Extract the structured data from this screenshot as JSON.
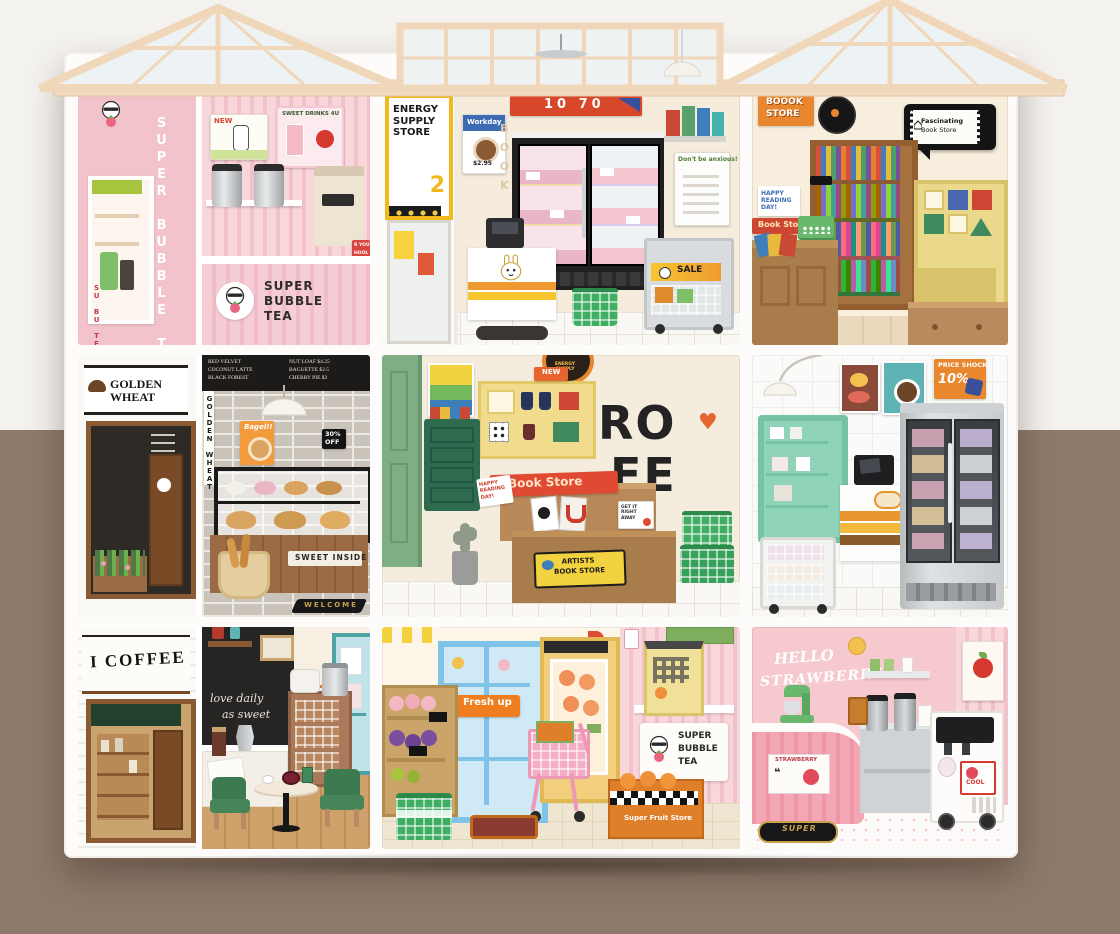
{
  "scene": {
    "backdrop": {
      "top_color": "#f4f2ef",
      "bottom_color": "#8d7a6b"
    }
  },
  "rooms": {
    "top_left": {
      "side_sign": "SUPER BUBBLE TEA",
      "side_small": "SU BU TE",
      "poster_new": "NEW",
      "poster_sweet": "SWEET DRINKS 4U",
      "counter_l1": "SUPER",
      "counter_l2": "BUBBLE",
      "counter_l3": "TEA",
      "partial_l1": "R YOUR",
      "partial_l2": "HOOL"
    },
    "top_center": {
      "sign": "ENERGY SUPPLY STORE",
      "sign_num": "2",
      "banner": "10 70",
      "workday": "Workday",
      "price": "$2.95",
      "sale": "SALE",
      "anxious": "Don't be anxious!",
      "wall_book": "BOOK"
    },
    "top_right": {
      "corner_l1": "BOOOK",
      "corner_l2": "STORE",
      "bubble_l1": "Fascinating",
      "bubble_l2": "Book Store",
      "happy": "HAPPY READING DAY!",
      "red_sign": "Book Store"
    },
    "mid_left": {
      "sign": "GOLDEN WHEAT",
      "hang_tag": "GOLDEN WHEAT",
      "menu_left": [
        "RED VELVET",
        "COCONUT LATTE",
        "BLACK FOREST"
      ],
      "menu_right": [
        "NUT LOAF $4.25",
        "BAGUETTE $2.5",
        "CHERRY PIE $3"
      ],
      "poster": "Bagel!!",
      "off_l1": "30%",
      "off_l2": "OFF",
      "plaque": "SWEET INSIDE",
      "mat": "WELCOME"
    },
    "mid_center": {
      "letters_l1": "RO",
      "letters_l2": "FE",
      "badge": "ENERGY SUPPLY",
      "banner": "Book Store",
      "artists_l1": "ARTISTS",
      "artists_l2": "BOOK STORE",
      "happy": "HAPPY READING DAY!",
      "new_flag": "NEW",
      "get_it": "GET IT RIGHT AWAY"
    },
    "mid_right": {
      "shock_l1": "PRICE SHOCK",
      "shock_l2": "10%"
    },
    "bottom_left": {
      "sign": "I COFFEE",
      "chalk_l1": "love daily",
      "chalk_l2": "as sweet"
    },
    "bottom_center": {
      "fresh": "Fresh up",
      "crate": "Super Fruit Store",
      "side_l1": "SUPER",
      "side_l2": "BUBBLE",
      "side_l3": "TEA"
    },
    "bottom_right": {
      "hello_l1": "HELLO",
      "hello_l2": "STRAWBERRY",
      "sticker": "STRAWBERRY",
      "quote": "❝",
      "cool": "COOL",
      "mat": "SUPER"
    }
  }
}
